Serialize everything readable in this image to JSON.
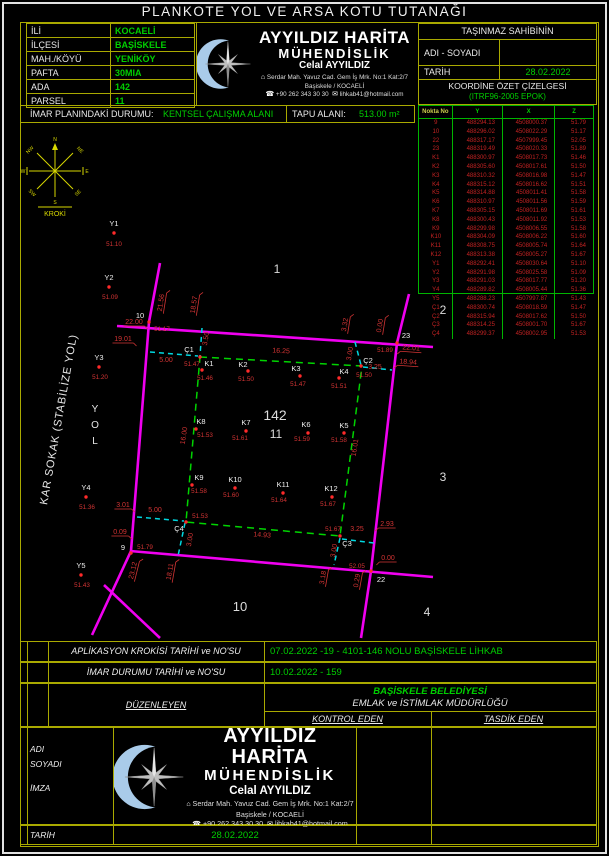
{
  "title": "PLANKOTE YOL VE ARSA KOTU TUTANAĞI",
  "parcel_info": {
    "rows": [
      {
        "label": "İLİ",
        "value": "KOCAELİ"
      },
      {
        "label": "İLÇESİ",
        "value": "BAŞİSKELE"
      },
      {
        "label": "MAH./KÖYÜ",
        "value": "YENİKÖY"
      },
      {
        "label": "PAFTA",
        "value": "30MIA"
      },
      {
        "label": "ADA",
        "value": "142"
      },
      {
        "label": "PARSEL",
        "value": "11"
      }
    ]
  },
  "company": {
    "name_line1": "AYYILDIZ HARİTA",
    "name_line2": "MÜHENDİSLİK",
    "person": "Celal AYYILDIZ",
    "address_line1": "Serdar Mah. Yavuz Cad. Gem İş Mrk. No:1 Kat:2/7",
    "address_line2": "Başiskele / KOCAELİ",
    "phone": "+90 262 343 30 30",
    "email": "lihkab41@hotmail.com",
    "address_icon": "⌂",
    "phone_icon": "☎",
    "mail_icon": "✉"
  },
  "owner_box": {
    "header": "TAŞINMAZ SAHİBİNİN",
    "name_label": "ADI - SOYADI",
    "name_value": "",
    "date_label": "TARİH",
    "date_value": "28.02.2022",
    "coord_title": "KOORDİNE ÖZET ÇİZELGESİ",
    "coord_subtitle": "(ITRF96-2005 EPOK)"
  },
  "coord_table": {
    "headers": [
      "Nokta  No",
      "Y",
      "X",
      "Z"
    ],
    "rows": [
      [
        "9",
        "488294.13",
        "4508000.37",
        "51.79"
      ],
      [
        "10",
        "488296.02",
        "4508022.29",
        "51.17"
      ],
      [
        "22",
        "488317.17",
        "4507999.45",
        "52.05"
      ],
      [
        "23",
        "488319.49",
        "4508020.33",
        "51.89"
      ],
      [
        "K1",
        "488300.97",
        "4508017.73",
        "51.46"
      ],
      [
        "K2",
        "488305.60",
        "4508017.61",
        "51.50"
      ],
      [
        "K3",
        "488310.32",
        "4508016.98",
        "51.47"
      ],
      [
        "K4",
        "488315.12",
        "4508016.62",
        "51.51"
      ],
      [
        "K5",
        "488314.88",
        "4508011.41",
        "51.58"
      ],
      [
        "K6",
        "488310.97",
        "4508011.56",
        "51.59"
      ],
      [
        "K7",
        "488305.15",
        "4508011.69",
        "51.61"
      ],
      [
        "K8",
        "488300.43",
        "4508011.92",
        "51.53"
      ],
      [
        "K9",
        "488299.98",
        "4508006.55",
        "51.58"
      ],
      [
        "K10",
        "488304.09",
        "4508006.22",
        "51.60"
      ],
      [
        "K11",
        "488308.75",
        "4508005.74",
        "51.64"
      ],
      [
        "K12",
        "488313.38",
        "4508005.27",
        "51.67"
      ],
      [
        "Y1",
        "488292.41",
        "4508030.64",
        "51.10"
      ],
      [
        "Y2",
        "488291.98",
        "4508025.58",
        "51.09"
      ],
      [
        "Y3",
        "488291.03",
        "4508017.77",
        "51.20"
      ],
      [
        "Y4",
        "488289.82",
        "4508005.44",
        "51.36"
      ],
      [
        "Y5",
        "488288.23",
        "4507997.87",
        "51.43"
      ],
      [
        "Ç1",
        "488300.74",
        "4508018.59",
        "51.47"
      ],
      [
        "Ç2",
        "488315.94",
        "4508017.62",
        "51.50"
      ],
      [
        "Ç3",
        "488314.25",
        "4508001.70",
        "51.67"
      ],
      [
        "Ç4",
        "488299.37",
        "4508002.95",
        "51.53"
      ]
    ]
  },
  "imar_row": {
    "label1": "İMAR PLANINDAKİ DURUMU:",
    "value1": "KENTSEL ÇALIŞMA ALANI",
    "label2": "TAPU ALANI:",
    "value2": "513.00 m²"
  },
  "drawing": {
    "street_label": "KAR SOKAK (STABİLİZE YOL)",
    "yol": [
      "Y",
      "O",
      "L"
    ],
    "compass": {
      "n": "N",
      "ne": "NE",
      "e": "E",
      "se": "SE",
      "s": "S",
      "sw": "SW",
      "w": "W",
      "nw": "NW",
      "label": "KROKİ"
    },
    "roads": [
      "117,326 433,347",
      "130,551 433,577",
      "160,263 149,322 131,551 92,635",
      "104,585 160,638",
      "409,294 397,343 371,571 361,638"
    ],
    "parcel": "200,357 362,366 340,536 186,522",
    "helpers": [
      "202,328 200,356",
      "150,352 198,356",
      "355,342 361,365",
      "363,367 392,370",
      "137,517 184,521",
      "185,523 178,556",
      "340,538 334,565",
      "342,539 374,543"
    ],
    "dims": [
      {
        "t": "22.00",
        "x": 134,
        "y": 324,
        "r": 0,
        "u": 1,
        "h": 1
      },
      {
        "t": "19.01",
        "x": 123,
        "y": 341,
        "r": 0,
        "u": 1,
        "h": 1
      },
      {
        "t": "21.56",
        "x": 163,
        "y": 303,
        "r": -81,
        "u": 1,
        "h": 1
      },
      {
        "t": "18.57",
        "x": 196,
        "y": 305,
        "r": -81,
        "u": 1,
        "h": 1
      },
      {
        "t": "3.50",
        "x": 208,
        "y": 339,
        "r": -81,
        "u": 0,
        "h": 1
      },
      {
        "t": "5.00",
        "x": 166,
        "y": 362,
        "r": 0,
        "u": 0,
        "h": 1
      },
      {
        "t": "16.25",
        "x": 281,
        "y": 353,
        "r": 3,
        "u": 0,
        "h": 1
      },
      {
        "t": "3.00",
        "x": 352,
        "y": 354,
        "r": -81,
        "u": 0,
        "h": 1
      },
      {
        "t": "3.25",
        "x": 375,
        "y": 369,
        "r": 0,
        "u": 0,
        "h": 1
      },
      {
        "t": "3.32",
        "x": 347,
        "y": 325,
        "r": -81,
        "u": 1,
        "h": 1
      },
      {
        "t": "0.00",
        "x": 382,
        "y": 326,
        "r": -81,
        "u": 1,
        "h": 1
      },
      {
        "t": "22.01",
        "x": 411,
        "y": 350,
        "r": 4,
        "u": 1,
        "h": -1
      },
      {
        "t": "18.94",
        "x": 408,
        "y": 364,
        "r": 4,
        "u": 1,
        "h": -1
      },
      {
        "t": "16.00",
        "x": 186,
        "y": 436,
        "r": -81,
        "u": 0,
        "h": 1
      },
      {
        "t": "16.01",
        "x": 357,
        "y": 448,
        "r": -81,
        "u": 0,
        "h": 1
      },
      {
        "t": "3.01",
        "x": 123,
        "y": 507,
        "r": 0,
        "u": 1,
        "h": 1
      },
      {
        "t": "5.00",
        "x": 155,
        "y": 512,
        "r": 0,
        "u": 0,
        "h": 1
      },
      {
        "t": "0.09",
        "x": 120,
        "y": 534,
        "r": 0,
        "u": 1,
        "h": 1
      },
      {
        "t": "14.93",
        "x": 262,
        "y": 537,
        "r": 4,
        "u": 0,
        "h": 1
      },
      {
        "t": "3.00",
        "x": 192,
        "y": 540,
        "r": -81,
        "u": 0,
        "h": 1
      },
      {
        "t": "3.00",
        "x": 336,
        "y": 551,
        "r": -81,
        "u": 0,
        "h": 1
      },
      {
        "t": "3.25",
        "x": 357,
        "y": 531,
        "r": 0,
        "u": 0,
        "h": 1
      },
      {
        "t": "2.93",
        "x": 387,
        "y": 526,
        "r": 0,
        "u": 1,
        "h": -1
      },
      {
        "t": "23.12",
        "x": 135,
        "y": 571,
        "r": -76,
        "u": 1,
        "h": 1
      },
      {
        "t": "18.11",
        "x": 172,
        "y": 572,
        "r": -80,
        "u": 1,
        "h": 1
      },
      {
        "t": "3.18",
        "x": 325,
        "y": 578,
        "r": -80,
        "u": 1,
        "h": 1
      },
      {
        "t": "0.29",
        "x": 359,
        "y": 581,
        "r": -80,
        "u": 1,
        "h": 1
      },
      {
        "t": "0.00",
        "x": 388,
        "y": 560,
        "r": 0,
        "u": 1,
        "h": -1
      }
    ],
    "points": [
      {
        "n": "Y1",
        "e": "51.10",
        "x": 114,
        "y": 233,
        "nx": 114,
        "ny": 226,
        "ex": 114,
        "ey": 246
      },
      {
        "n": "Y2",
        "e": "51.09",
        "x": 109,
        "y": 287,
        "nx": 109,
        "ny": 280,
        "ex": 110,
        "ey": 299
      },
      {
        "n": "Y3",
        "e": "51.20",
        "x": 99,
        "y": 367,
        "nx": 99,
        "ny": 360,
        "ex": 100,
        "ey": 379
      },
      {
        "n": "Y4",
        "e": "51.36",
        "x": 86,
        "y": 497,
        "nx": 86,
        "ny": 490,
        "ex": 87,
        "ey": 509
      },
      {
        "n": "Y5",
        "e": "51.43",
        "x": 81,
        "y": 575,
        "nx": 81,
        "ny": 568,
        "ex": 82,
        "ey": 587
      },
      {
        "n": "10",
        "e": "51.17",
        "x": 149,
        "y": 322,
        "nx": 140,
        "ny": 318,
        "ex": 162,
        "ey": 331
      },
      {
        "n": "23",
        "e": "51.89",
        "x": 397,
        "y": 343,
        "nx": 406,
        "ny": 338,
        "ex": 385,
        "ey": 352
      },
      {
        "n": "9",
        "e": "51.79",
        "x": 131,
        "y": 553,
        "nx": 123,
        "ny": 550,
        "ex": 145,
        "ey": 549
      },
      {
        "n": "22",
        "e": "52.05",
        "x": 371,
        "y": 571,
        "nx": 381,
        "ny": 582,
        "ex": 357,
        "ey": 568
      },
      {
        "n": "K1",
        "e": "51.46",
        "x": 202,
        "y": 370,
        "nx": 209,
        "ny": 366,
        "ex": 205,
        "ey": 380
      },
      {
        "n": "K2",
        "e": "51.50",
        "x": 248,
        "y": 371,
        "nx": 243,
        "ny": 367,
        "ex": 246,
        "ey": 381
      },
      {
        "n": "K3",
        "e": "51.47",
        "x": 300,
        "y": 376,
        "nx": 296,
        "ny": 371,
        "ex": 298,
        "ey": 386
      },
      {
        "n": "K4",
        "e": "51.51",
        "x": 339,
        "y": 378,
        "nx": 344,
        "ny": 374,
        "ex": 339,
        "ey": 388
      },
      {
        "n": "K5",
        "e": "51.58",
        "x": 344,
        "y": 433,
        "nx": 344,
        "ny": 428,
        "ex": 339,
        "ey": 442
      },
      {
        "n": "K6",
        "e": "51.59",
        "x": 308,
        "y": 433,
        "nx": 306,
        "ny": 427,
        "ex": 302,
        "ey": 441
      },
      {
        "n": "K7",
        "e": "51.61",
        "x": 246,
        "y": 431,
        "nx": 246,
        "ny": 425,
        "ex": 240,
        "ey": 440
      },
      {
        "n": "K8",
        "e": "51.53",
        "x": 196,
        "y": 429,
        "nx": 201,
        "ny": 424,
        "ex": 205,
        "ey": 437
      },
      {
        "n": "K9",
        "e": "51.58",
        "x": 192,
        "y": 485,
        "nx": 199,
        "ny": 480,
        "ex": 199,
        "ey": 493
      },
      {
        "n": "K10",
        "e": "51.60",
        "x": 235,
        "y": 488,
        "nx": 235,
        "ny": 482,
        "ex": 231,
        "ey": 497
      },
      {
        "n": "K11",
        "e": "51.64",
        "x": 283,
        "y": 493,
        "nx": 283,
        "ny": 487,
        "ex": 279,
        "ey": 502
      },
      {
        "n": "K12",
        "e": "51.67",
        "x": 332,
        "y": 497,
        "nx": 331,
        "ny": 491,
        "ex": 328,
        "ey": 506
      },
      {
        "n": "Ç1",
        "e": "51.47",
        "x": 200,
        "y": 357,
        "nx": 189,
        "ny": 352,
        "ex": 192,
        "ey": 366
      },
      {
        "n": "Ç2",
        "e": "51.50",
        "x": 361,
        "y": 366,
        "nx": 368,
        "ny": 363,
        "ex": 364,
        "ey": 377
      },
      {
        "n": "Ç3",
        "e": "51.67",
        "x": 340,
        "y": 536,
        "nx": 347,
        "ny": 546,
        "ex": 333,
        "ey": 531
      },
      {
        "n": "Ç4",
        "e": "51.53",
        "x": 186,
        "y": 522,
        "nx": 179,
        "ny": 531,
        "ex": 200,
        "ey": 518
      }
    ],
    "blocks": [
      {
        "t": "1",
        "x": 277,
        "y": 273,
        "s": 12
      },
      {
        "t": "2",
        "x": 443,
        "y": 314,
        "s": 12
      },
      {
        "t": "3",
        "x": 443,
        "y": 481,
        "s": 12
      },
      {
        "t": "4",
        "x": 427,
        "y": 616,
        "s": 12
      },
      {
        "t": "10",
        "x": 240,
        "y": 611,
        "s": 13
      },
      {
        "t": "142",
        "x": 275,
        "y": 420,
        "s": 14
      },
      {
        "t": "11",
        "x": 276,
        "y": 438,
        "s": 12
      }
    ]
  },
  "bottom": {
    "row_a_label": "APLİKASYON KROKİSİ TARİHİ ve NO'SU",
    "row_a_value": "07.02.2022 -19 - 4101-146 NOLU BAŞİSKELE LİHKAB",
    "row_b_label": "İMAR DURUMU TARİHİ ve NO'SU",
    "row_b_value": "10.02.2022 - 159",
    "duzenleyen": "DÜZENLEYEN",
    "municipality": "BAŞİSKELE BELEDİYESİ",
    "directorate": "EMLAK ve İSTİMLAK MÜDÜRLÜĞÜ",
    "kontrol": "KONTROL EDEN",
    "tasdik": "TASDİK EDEN",
    "adi": "ADI",
    "soyadi": "SOYADI",
    "imza": "İMZA",
    "tarih_label": "TARİH",
    "tarih_value": "28.02.2022"
  }
}
